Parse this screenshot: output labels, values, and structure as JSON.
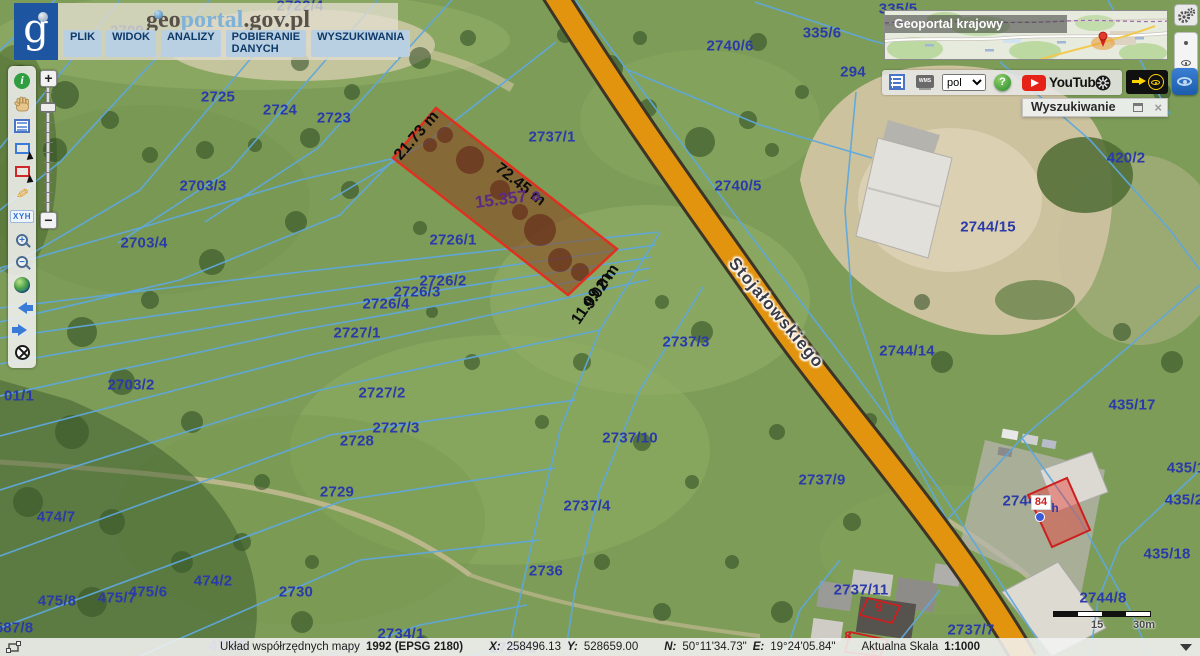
{
  "header": {
    "logo_glyph": "g",
    "title_geo": "geo",
    "title_portal": "portal",
    "title_suffix": ".gov.pl",
    "menu": [
      {
        "label": "PLIK"
      },
      {
        "label": "WIDOK"
      },
      {
        "label": "ANALIZY"
      },
      {
        "label": "POBIERANIE DANYCH"
      },
      {
        "label": "WYSZUKIWANIA"
      }
    ]
  },
  "left_toolbar": {
    "info_glyph": "i",
    "xyh_label": "XYH",
    "zoom_in_glyph": "+",
    "zoom_out_glyph": "−"
  },
  "zoom_slider": {
    "plus": "+",
    "minus": "−"
  },
  "minimap": {
    "title": "Geoportal krajowy"
  },
  "right_toolbar": {
    "wms_label": "WMS",
    "language": "pol",
    "help_glyph": "?",
    "youtube_label": "YouTube"
  },
  "search_panel": {
    "title": "Wyszukiwanie"
  },
  "scalebar": {
    "mid": "15",
    "end": "30m"
  },
  "statusbar": {
    "label": "Układ współrzędnych mapy",
    "crs": "1992 (EPSG 2180)",
    "xl": "X:",
    "xv": "258496.13",
    "yl": "Y:",
    "yv": "528659.00",
    "nl": "N:",
    "nv": "50°11'34.73\"",
    "el": "E:",
    "ev": "19°24'05.84\"",
    "scale_label": "Aktualna Skala",
    "scale_value": "1:1000"
  },
  "map": {
    "address_badge": "84",
    "colors": {
      "parcel_line": "#5fa8dc",
      "road": "#e2940e",
      "highlight": "#e03020",
      "label_blue": "#2a3aa8"
    },
    "labels": [
      {
        "t": "2709",
        "x": 127,
        "y": 31,
        "c": "pl"
      },
      {
        "t": "2722/4",
        "x": 300,
        "y": 6,
        "c": "pl"
      },
      {
        "t": "2725",
        "x": 218,
        "y": 97,
        "c": "pl"
      },
      {
        "t": "2724",
        "x": 280,
        "y": 110,
        "c": "pl"
      },
      {
        "t": "2723",
        "x": 334,
        "y": 118,
        "c": "pl"
      },
      {
        "t": "2703/3",
        "x": 203,
        "y": 186,
        "c": "pl"
      },
      {
        "t": "2703/4",
        "x": 144,
        "y": 243,
        "c": "pl"
      },
      {
        "t": "2737/1",
        "x": 552,
        "y": 137,
        "c": "pl"
      },
      {
        "t": "2726/1",
        "x": 453,
        "y": 240,
        "c": "pl"
      },
      {
        "t": "2726/2",
        "x": 443,
        "y": 281,
        "c": "pl"
      },
      {
        "t": "2726/3",
        "x": 417,
        "y": 292,
        "c": "pl"
      },
      {
        "t": "2726/4",
        "x": 386,
        "y": 304,
        "c": "pl"
      },
      {
        "t": "2727/1",
        "x": 357,
        "y": 333,
        "c": "pl"
      },
      {
        "t": "2703/2",
        "x": 131,
        "y": 385,
        "c": "pl"
      },
      {
        "t": "01/1",
        "x": 19,
        "y": 396,
        "c": "pl"
      },
      {
        "t": "2727/2",
        "x": 382,
        "y": 393,
        "c": "pl"
      },
      {
        "t": "2727/3",
        "x": 396,
        "y": 428,
        "c": "pl"
      },
      {
        "t": "2728",
        "x": 357,
        "y": 441,
        "c": "pl"
      },
      {
        "t": "2729",
        "x": 337,
        "y": 492,
        "c": "pl"
      },
      {
        "t": "2730",
        "x": 296,
        "y": 592,
        "c": "pl"
      },
      {
        "t": "474/7",
        "x": 56,
        "y": 517,
        "c": "pl"
      },
      {
        "t": "475/8",
        "x": 57,
        "y": 601,
        "c": "pl"
      },
      {
        "t": "475/7",
        "x": 117,
        "y": 598,
        "c": "pl"
      },
      {
        "t": "475/6",
        "x": 148,
        "y": 592,
        "c": "pl"
      },
      {
        "t": "474/2",
        "x": 213,
        "y": 581,
        "c": "pl"
      },
      {
        "t": "587/8",
        "x": 14,
        "y": 628,
        "c": "pl"
      },
      {
        "t": "475/5",
        "x": 228,
        "y": 646,
        "c": "pl"
      },
      {
        "t": "2734/1",
        "x": 401,
        "y": 634,
        "c": "pl"
      },
      {
        "t": "2734/2",
        "x": 513,
        "y": 648,
        "c": "pl"
      },
      {
        "t": "2736",
        "x": 546,
        "y": 571,
        "c": "pl"
      },
      {
        "t": "2737/4",
        "x": 587,
        "y": 506,
        "c": "pl"
      },
      {
        "t": "2737/10",
        "x": 630,
        "y": 438,
        "c": "pl"
      },
      {
        "t": "2737/3",
        "x": 686,
        "y": 342,
        "c": "pl"
      },
      {
        "t": "2737/9",
        "x": 822,
        "y": 480,
        "c": "pl"
      },
      {
        "t": "2737/11",
        "x": 861,
        "y": 590,
        "c": "pl"
      },
      {
        "t": "2737/7",
        "x": 971,
        "y": 630,
        "c": "pl"
      },
      {
        "t": "2740/6",
        "x": 730,
        "y": 46,
        "c": "pl"
      },
      {
        "t": "2740/5",
        "x": 738,
        "y": 186,
        "c": "pl"
      },
      {
        "t": "335/6",
        "x": 822,
        "y": 33,
        "c": "pl"
      },
      {
        "t": "335/5",
        "x": 898,
        "y": 9,
        "c": "pl"
      },
      {
        "t": "294",
        "x": 853,
        "y": 72,
        "c": "pl"
      },
      {
        "t": "2744/15",
        "x": 988,
        "y": 227,
        "c": "pl"
      },
      {
        "t": "2744/14",
        "x": 907,
        "y": 351,
        "c": "pl"
      },
      {
        "t": "420/2",
        "x": 1126,
        "y": 158,
        "c": "pl"
      },
      {
        "t": "435/17",
        "x": 1132,
        "y": 405,
        "c": "pl"
      },
      {
        "t": "435/1",
        "x": 1186,
        "y": 468,
        "c": "pl"
      },
      {
        "t": "435/2",
        "x": 1184,
        "y": 500,
        "c": "pl"
      },
      {
        "t": "435/18",
        "x": 1167,
        "y": 554,
        "c": "pl"
      },
      {
        "t": "2744/8",
        "x": 1103,
        "y": 598,
        "c": "pl"
      },
      {
        "t": "2744/7",
        "x": 1026,
        "y": 501,
        "c": "pl"
      },
      {
        "t": "h",
        "x": 1055,
        "y": 508,
        "c": "pl-sm"
      },
      {
        "t": "Stojałowskiego",
        "x": 776,
        "y": 313,
        "c": "street",
        "rot": 50
      },
      {
        "t": "21.73 m",
        "x": 417,
        "y": 136,
        "c": "meas",
        "rot": -49
      },
      {
        "t": "72.45 m",
        "x": 520,
        "y": 185,
        "c": "meas",
        "rot": 38
      },
      {
        "t": "15.357 a",
        "x": 508,
        "y": 199,
        "c": "area",
        "rot": -7
      },
      {
        "t": "11.09 m",
        "x": 592,
        "y": 299,
        "c": "meas",
        "rot": -56
      },
      {
        "t": "9.02 m",
        "x": 602,
        "y": 287,
        "c": "meas",
        "rot": -56
      },
      {
        "t": "9",
        "x": 879,
        "y": 607,
        "c": "addr",
        "rot": -12
      },
      {
        "t": "8",
        "x": 848,
        "y": 636,
        "c": "addr"
      },
      {
        "t": "9",
        "x": 874,
        "y": 648,
        "c": "addr",
        "rot": -10
      }
    ]
  }
}
